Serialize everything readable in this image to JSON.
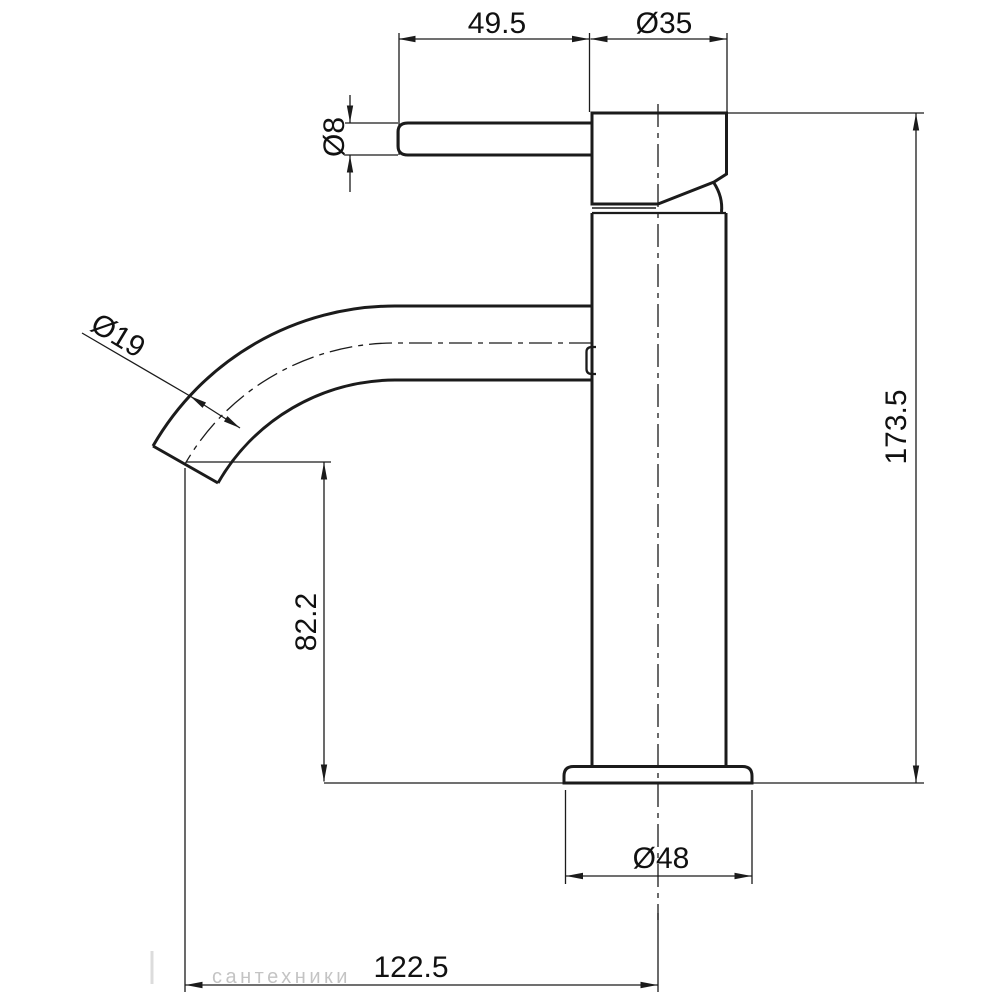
{
  "drawing": {
    "background_color": "#ffffff",
    "line_color": "#1b1b1b",
    "text_color": "#111111",
    "labels": {
      "handle_length": "49.5",
      "head_diameter": "Ø35",
      "handle_diameter": "Ø8",
      "spout_diameter": "Ø19",
      "overall_height": "173.5",
      "spout_outlet_height": "82.2",
      "base_diameter": "Ø48",
      "spout_reach": "122.5"
    },
    "watermark": {
      "text": "сантехники",
      "color": "#b6b6b6"
    }
  }
}
